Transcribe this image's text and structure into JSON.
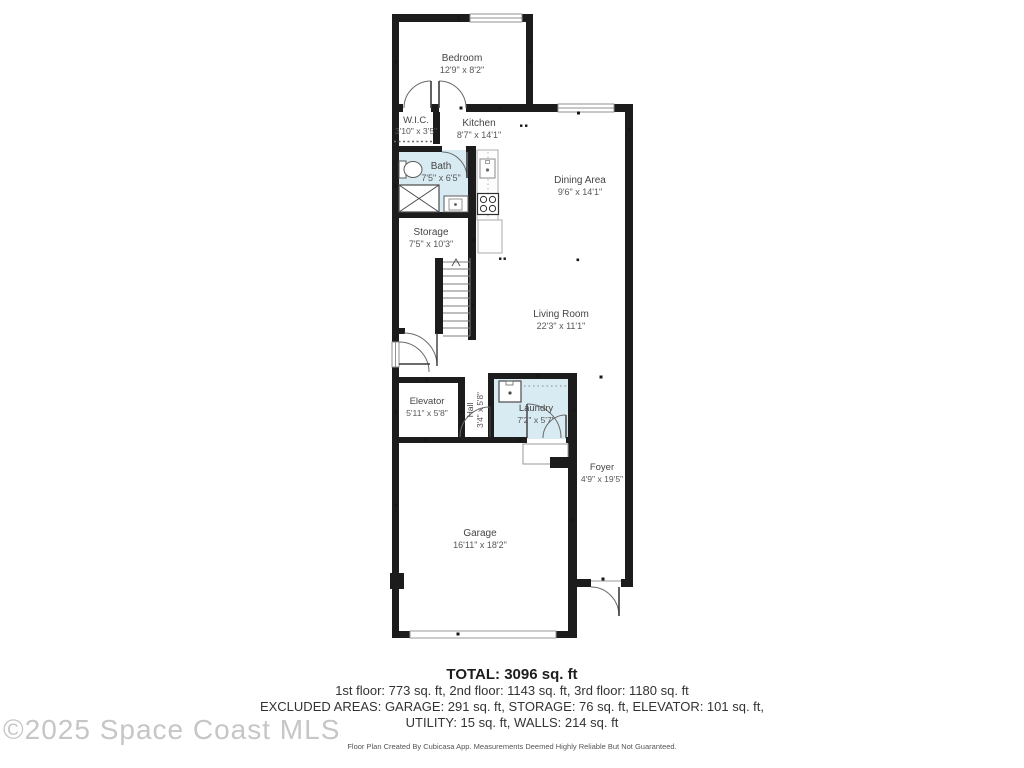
{
  "plan": {
    "rooms": {
      "bedroom": {
        "name": "Bedroom",
        "dims": "12'9\" x 8'2\""
      },
      "wic": {
        "name": "W.I.C.",
        "dims": "3'10\" x 3'5\""
      },
      "kitchen": {
        "name": "Kitchen",
        "dims": "8'7\" x 14'1\""
      },
      "bath": {
        "name": "Bath",
        "dims": "7'5\" x 6'5\""
      },
      "dining": {
        "name": "Dining Area",
        "dims": "9'6\" x 14'1\""
      },
      "storage": {
        "name": "Storage",
        "dims": "7'5\" x 10'3\""
      },
      "living": {
        "name": "Living Room",
        "dims": "22'3\" x 11'1\""
      },
      "elevator": {
        "name": "Elevator",
        "dims": "5'11\" x 5'8\""
      },
      "hall": {
        "name": "Hall",
        "dims": "3'4\" x 5'8\""
      },
      "laundry": {
        "name": "Laundry",
        "dims": "7'2\" x 5'7\""
      },
      "foyer": {
        "name": "Foyer",
        "dims": "4'9\" x 19'5\""
      },
      "garage": {
        "name": "Garage",
        "dims": "16'11\" x 18'2\""
      }
    },
    "colors": {
      "wall": "#1c1c1c",
      "wet_room_fill": "#d8ebf2"
    }
  },
  "footer": {
    "total": "TOTAL: 3096 sq. ft",
    "floors": "1st floor: 773 sq. ft, 2nd floor: 1143 sq. ft, 3rd floor: 1180 sq. ft",
    "excluded": "EXCLUDED AREAS: GARAGE: 291 sq. ft, STORAGE: 76 sq. ft, ELEVATOR: 101 sq. ft,",
    "utility": "UTILITY: 15 sq. ft, WALLS: 214 sq. ft",
    "disclaimer": "Floor Plan Created By Cubicasa App. Measurements Deemed Highly Reliable But Not Guaranteed."
  },
  "watermark": "©2025 Space Coast MLS"
}
